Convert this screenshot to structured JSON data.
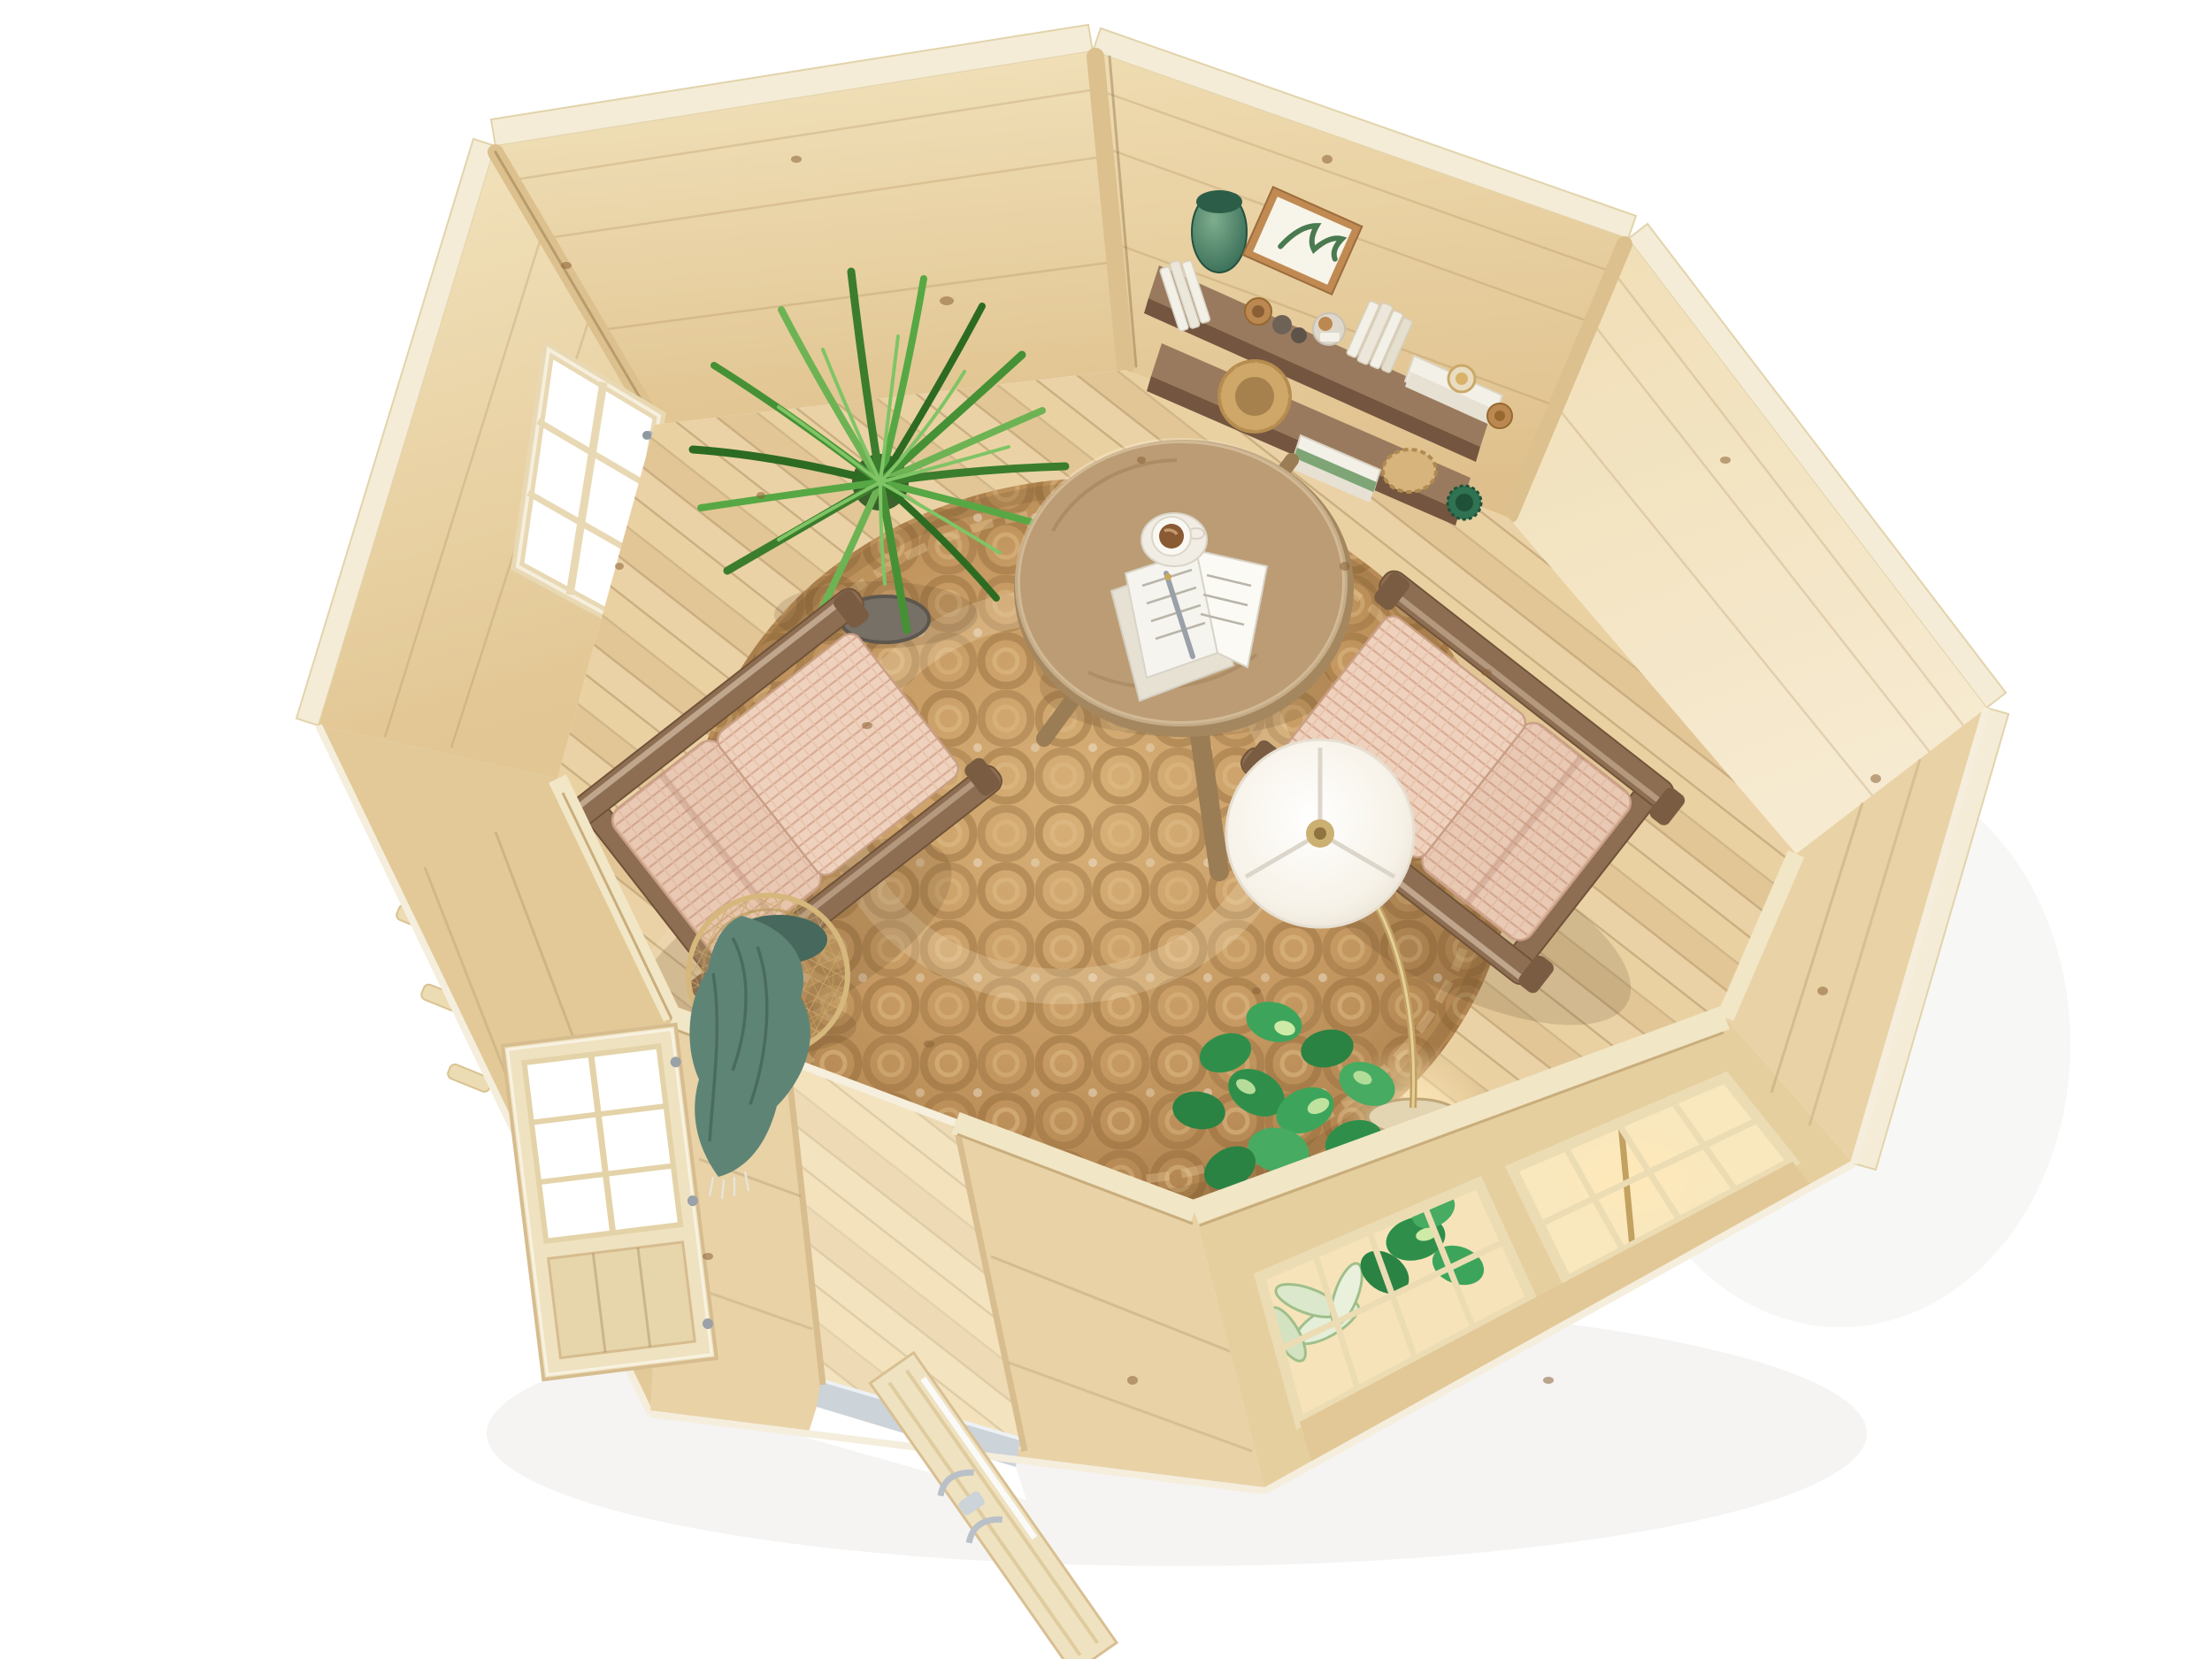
{
  "meta": {
    "title": "Aerial 3D render of an octagonal wooden garden cabin interior with reading corner",
    "view": "top-down isometric product render",
    "background": "#ffffff"
  },
  "colors": {
    "background": "#ffffff",
    "floor": "#e9cf9f",
    "wall_back_left": "#ecd8ad",
    "wall_back_right": "#e9d2a4",
    "wall_right": "#f1e0b8",
    "wall_left_upper": "#e3cb9d",
    "band_front": "#e8d2a6",
    "band_bottom_right": "#e6cf9f",
    "band_left_lower": "#e2c997",
    "band_right_lower": "#e9d2a5",
    "trim": "#f4ecd6",
    "plate": "#f1e6c6",
    "post": "#dcc08d",
    "rug": "#c69a62",
    "shelf": "#9a7a5e",
    "shelf_edge": "#74553f",
    "chair_wood": "#8d6e52",
    "weave": "#e9c9b4",
    "weave_seat": "#efd2bd",
    "table": "#bb9c74",
    "table_edge": "#a5875f",
    "lamp_shade": "#fbf7ef",
    "lamp_brass": "#c2a161",
    "lamp_glow": "#ffe9b8",
    "coffee": "#8a5a33",
    "page": "#f6f4ee",
    "palm": "#2e6b22",
    "palm_mid": "#469135",
    "palm_light": "#6db354",
    "pothos": "#2f8f4a",
    "pothos_variegation": "#cdeaa6",
    "aglaonema": "#e4eed8",
    "aglaonema_edge": "#9fbf8a",
    "blanket": "#5e8476",
    "blanket_fold": "#47685c",
    "basket_wire": "#c9a96a",
    "vase": "#3c7a60",
    "vase_dark": "#2c5d48",
    "glass_warm": "#fff0cd",
    "threshold": "#ccd3d9",
    "metal": "#aeb6bf",
    "knot": "#8a6337",
    "cork": "#bc8851",
    "book_white": "#f3f0e8",
    "book_shadow": "#e6e1d2",
    "plate_weave": "#d7b47c",
    "cup_green": "#2f7352",
    "pot_gray": "#767066"
  },
  "scene": {
    "objects": [
      {
        "id": "cabin-shell",
        "label": "Octagonal log cabin shell, natural pine"
      },
      {
        "id": "floor",
        "label": "Diagonal pine plank floor"
      },
      {
        "id": "rug",
        "label": "Round braided jute rug with spiral pattern"
      },
      {
        "id": "coffee-table",
        "label": "Round wooden coffee table"
      },
      {
        "id": "coffee-cup",
        "label": "Coffee cup on saucer"
      },
      {
        "id": "open-book",
        "label": "Open notebook with pen"
      },
      {
        "id": "chair-left",
        "label": "Woven paper-cord lounge chair, left"
      },
      {
        "id": "chair-right",
        "label": "Woven paper-cord lounge chair, right"
      },
      {
        "id": "floor-lamp",
        "label": "Arc floor lamp with white drum shade"
      },
      {
        "id": "palm-plant",
        "label": "Potted areca palm"
      },
      {
        "id": "pothos-plant",
        "label": "Potted pothos by the front window"
      },
      {
        "id": "aglaonema-plant",
        "label": "Variegated plant seen through window"
      },
      {
        "id": "corner-shelves",
        "label": "Two walnut corner wall shelves"
      },
      {
        "id": "green-vase",
        "label": "Green ceramic vase"
      },
      {
        "id": "framed-print",
        "label": "Framed botanical print"
      },
      {
        "id": "shelf-books",
        "label": "White books and jars with cork lids"
      },
      {
        "id": "shelf-basket",
        "label": "Small woven basket"
      },
      {
        "id": "hourglass",
        "label": "Hourglass on stacked books"
      },
      {
        "id": "wire-basket",
        "label": "Wire basket with draped green throw"
      },
      {
        "id": "green-throw",
        "label": "Sage green knit throw blanket"
      },
      {
        "id": "door-open",
        "label": "Glazed double door, left leaf swung open"
      },
      {
        "id": "door-leaf-front",
        "label": "Second door leaf seen edge-on with metal handles"
      },
      {
        "id": "threshold",
        "label": "Aluminium door threshold"
      },
      {
        "id": "window-left",
        "label": "Georgian-bar window, upper-left wall"
      },
      {
        "id": "windows-front",
        "label": "Georgian-bar double window, lower-right wall"
      }
    ]
  }
}
